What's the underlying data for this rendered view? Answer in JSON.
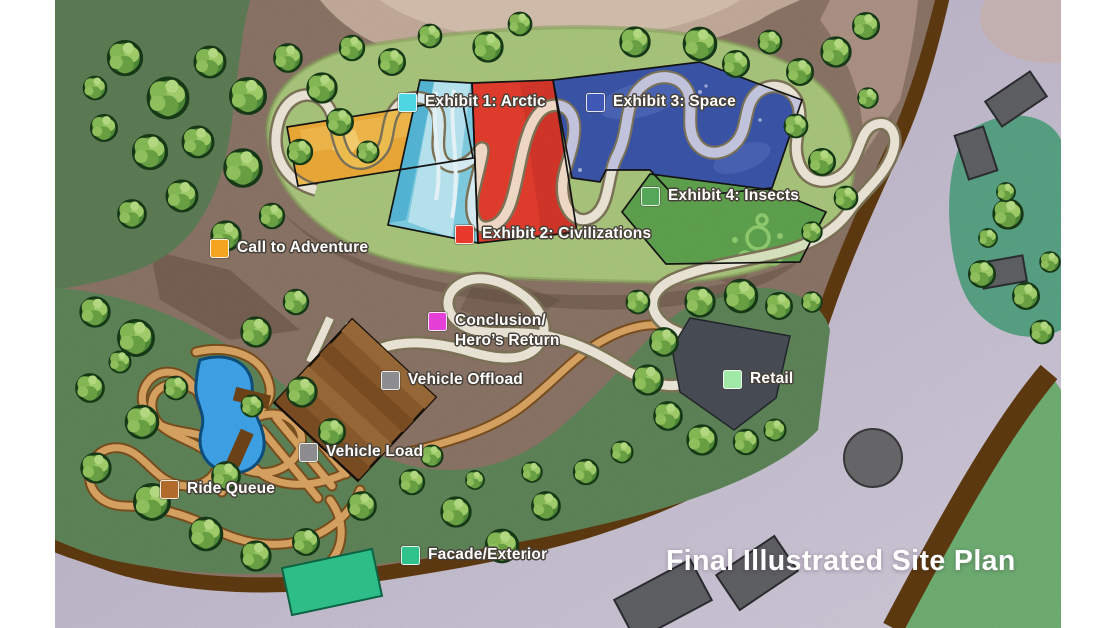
{
  "title": "Final Illustrated Site Plan",
  "legend": {
    "items": [
      {
        "label": "Exhibit 1: Arctic",
        "color": "#4fd6e3"
      },
      {
        "label": "Exhibit 3: Space",
        "color": "#3f57b5"
      },
      {
        "label": "Exhibit 4: Insects",
        "color": "#55a659"
      },
      {
        "label": "Exhibit 2: Civilizations",
        "color": "#e8392c"
      },
      {
        "label": "Call to Adventure",
        "color": "#f5a41f"
      },
      {
        "label": "Conclusion/",
        "label2": "Hero’s Return",
        "color": "#e43fd6"
      },
      {
        "label": "Vehicle Offload",
        "color": "#8d8d90"
      },
      {
        "label": "Vehicle Load",
        "color": "#8d8d90"
      },
      {
        "label": "Retail",
        "color": "#9fe8a6"
      },
      {
        "label": "Ride Queue",
        "color": "#b06b2a"
      },
      {
        "label": "Facade/Exterior",
        "color": "#2fc28b"
      }
    ]
  }
}
